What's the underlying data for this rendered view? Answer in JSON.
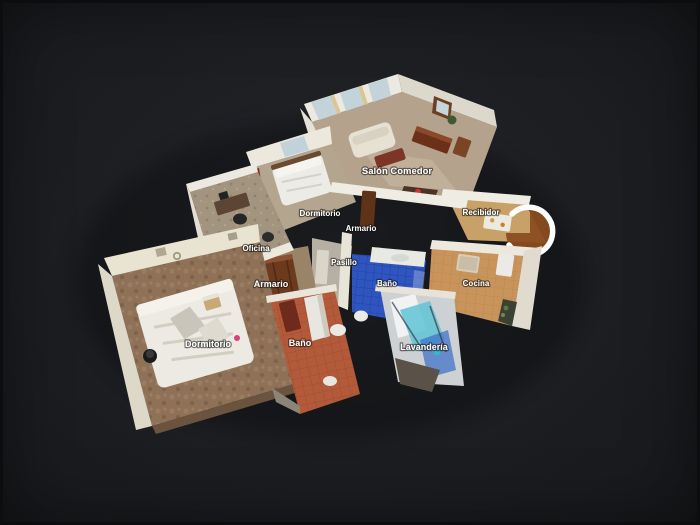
{
  "viewer": {
    "view_mode": "3d-dollhouse",
    "background_color": "#1d1f23",
    "label_text_color": "#ffffff"
  },
  "palette": {
    "wall_white": "#ece8dd",
    "salon_carpet": "#b5a28c",
    "kitchen_tile": "#c8945c",
    "hall_floor": "#c7a167",
    "blue_bath_floor": "#2e55c0",
    "terracotta_bath_floor": "#b25a3a",
    "bedroom_floor": "#8e7157",
    "wood_dark": "#6b3018",
    "door_arc": "#ffffff"
  },
  "rooms": [
    {
      "label": "Salón Comedor"
    },
    {
      "label": "Dormitorio"
    },
    {
      "label": "Armario"
    },
    {
      "label": "Recibidor"
    },
    {
      "label": "Oficina"
    },
    {
      "label": "Pasillo"
    },
    {
      "label": "Baño"
    },
    {
      "label": "Cocina"
    },
    {
      "label": "Armario"
    },
    {
      "label": "Dormitorio"
    },
    {
      "label": "Baño"
    },
    {
      "label": "Lavandería"
    }
  ]
}
